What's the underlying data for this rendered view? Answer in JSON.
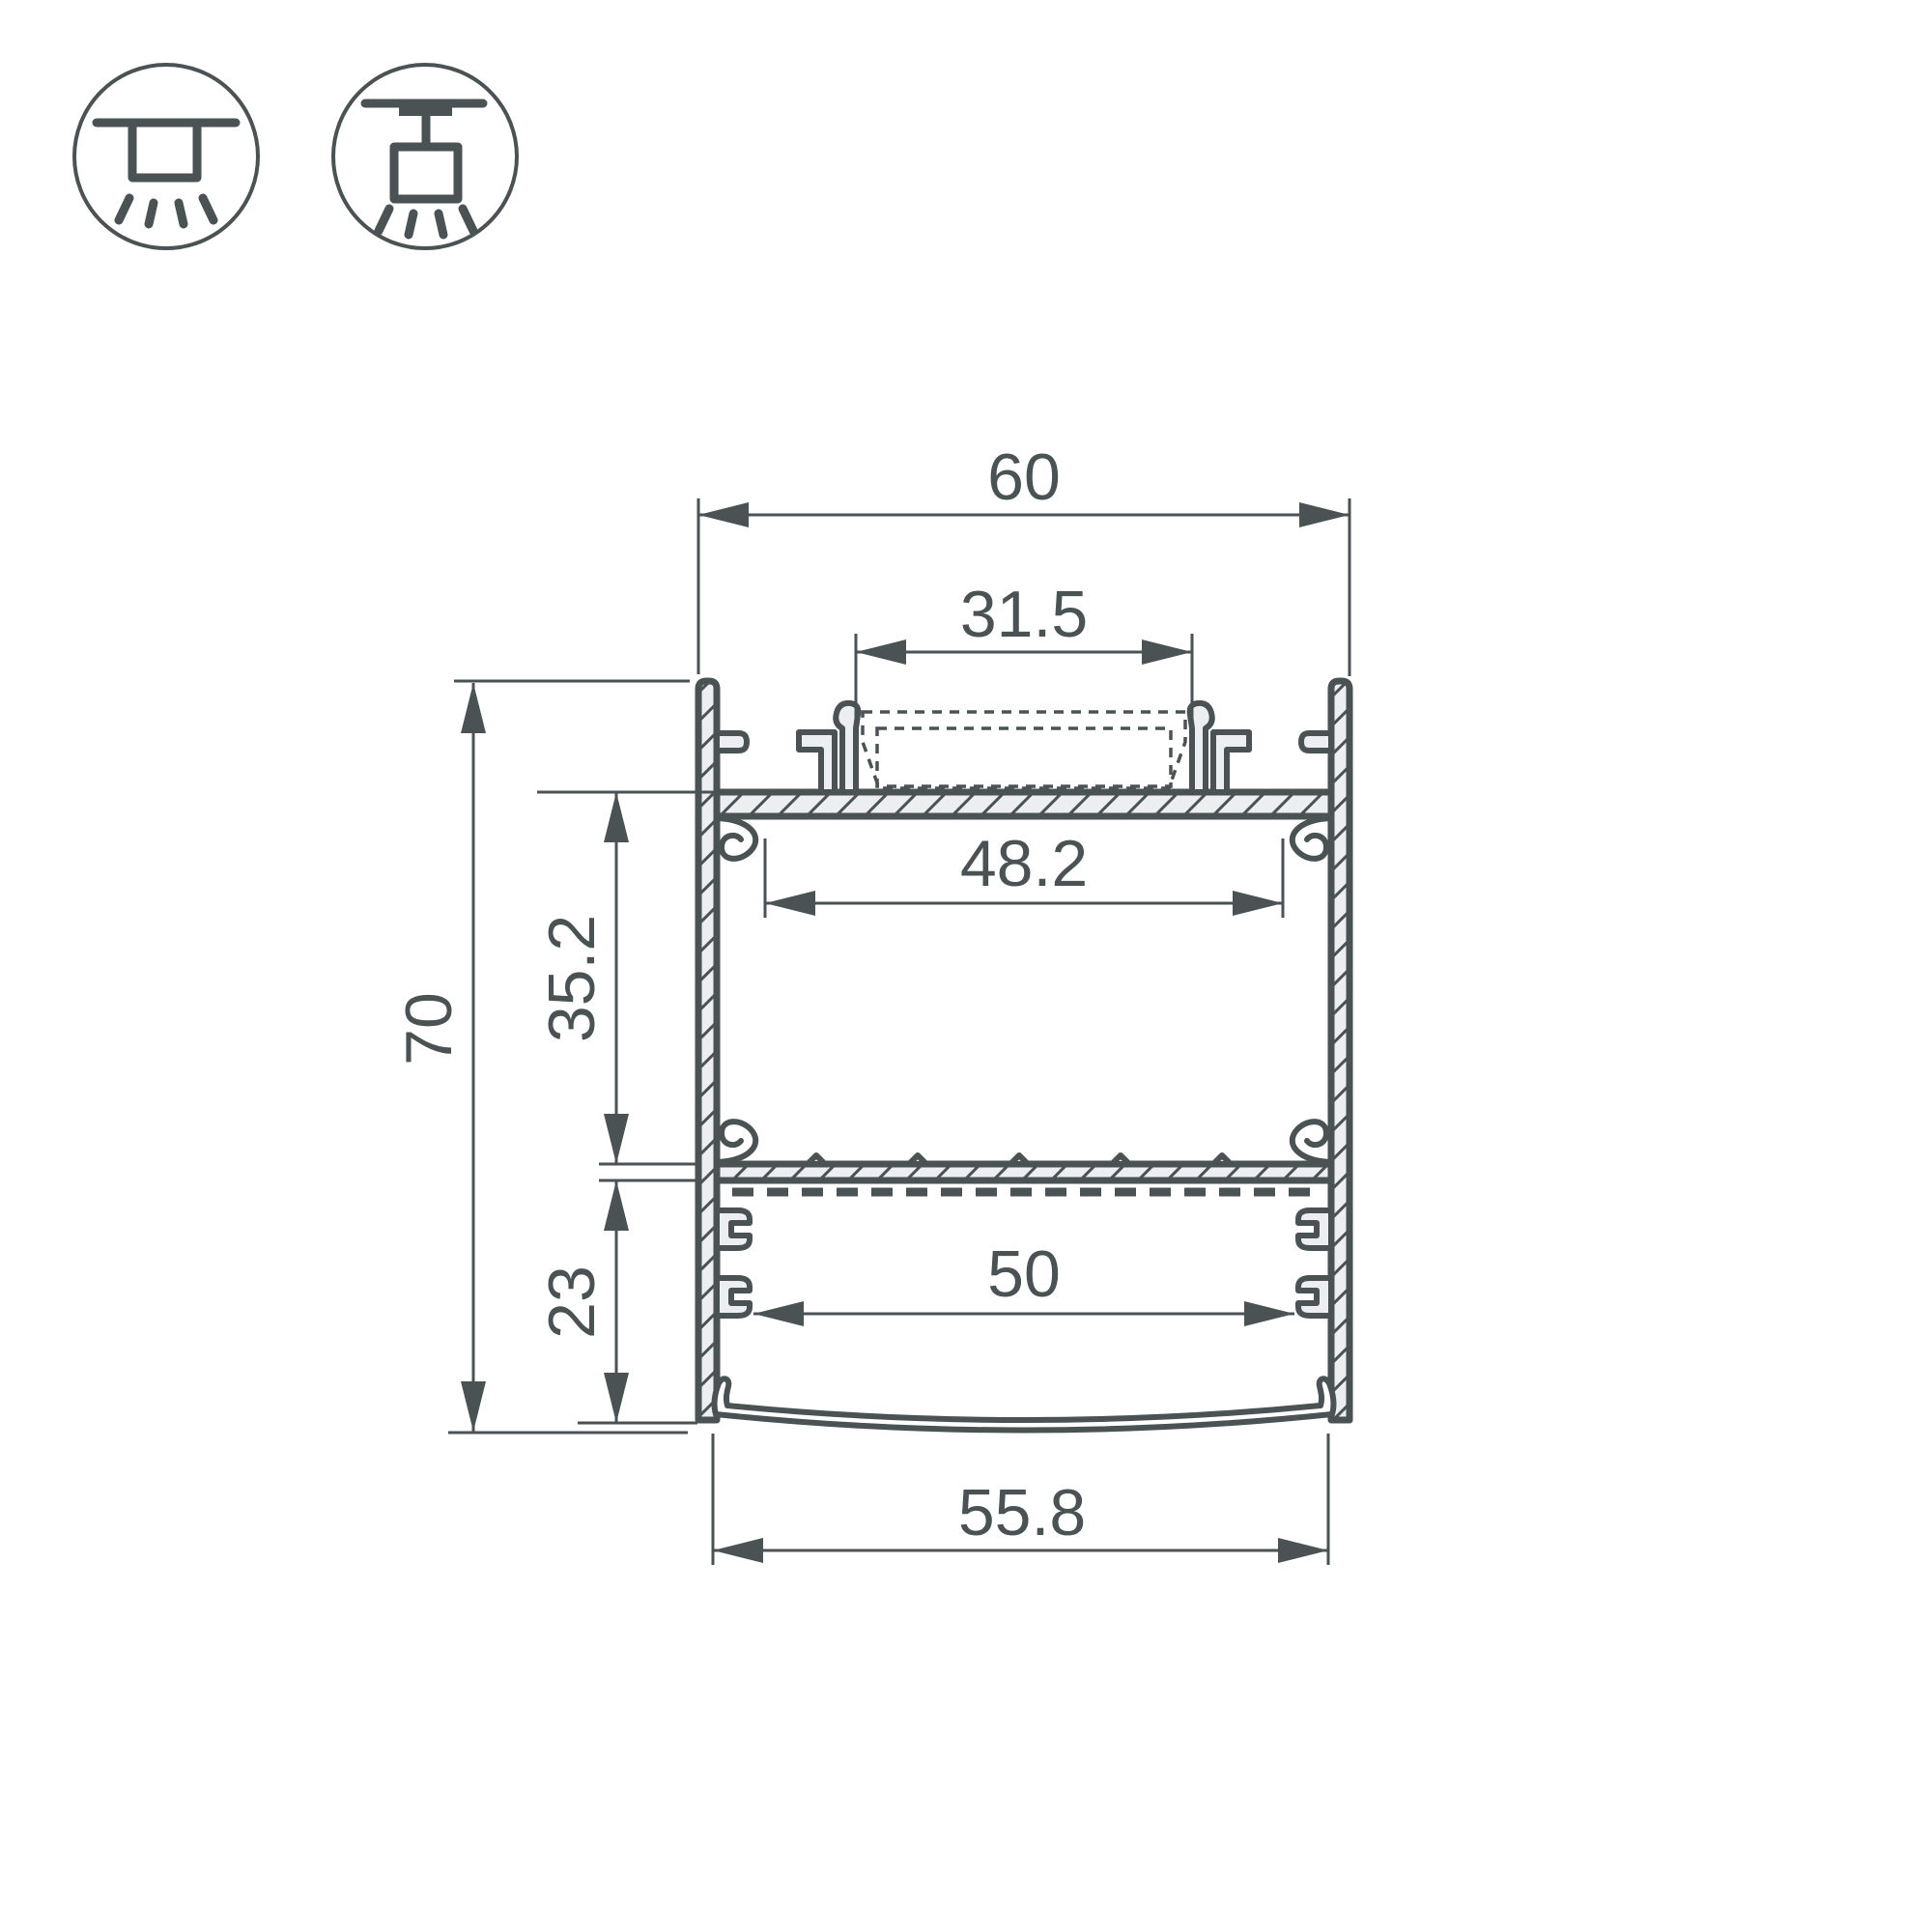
{
  "title": "LED profile cross-section drawing",
  "colors": {
    "line": "#4a5254",
    "aluminum_fill": "#eceef0",
    "background": "#ffffff"
  },
  "icons": {
    "surface_mount": "surface-mount-luminaire-icon",
    "pendant_mount": "pendant-mount-luminaire-icon"
  },
  "dimensions": {
    "outer_width": "60",
    "led_slot_width": "31.5",
    "inner_width": "48.2",
    "total_height": "70",
    "upper_chamber_height": "35.2",
    "lower_chamber_height": "23",
    "lower_inner_width": "50",
    "diffuser_width": "55.8"
  }
}
